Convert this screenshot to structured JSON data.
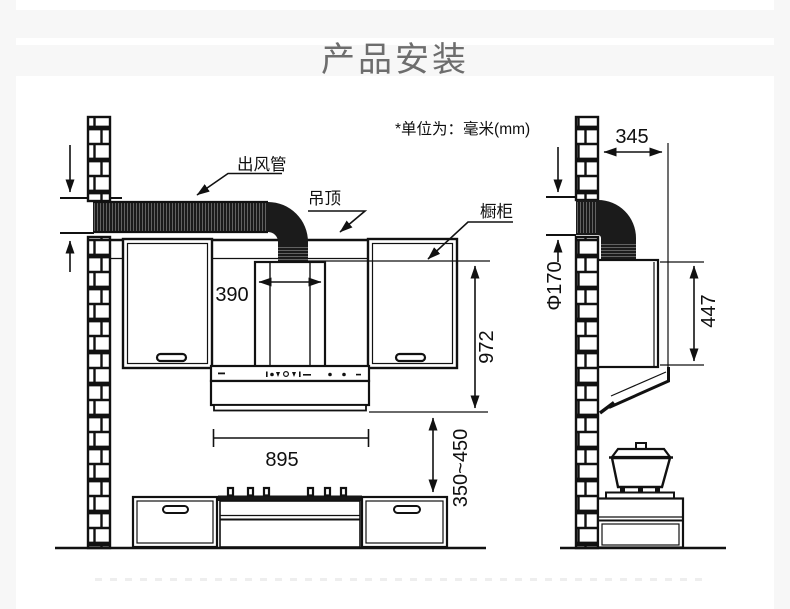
{
  "page": {
    "title": "产品安装",
    "unit_note": "*单位为：毫米(mm)"
  },
  "front_view": {
    "duct_label": "出风管",
    "ceiling_label": "吊顶",
    "cabinet_label": "橱柜",
    "dim_chimney_width": "390",
    "dim_hood_width": "895",
    "dim_ceiling_to_hood_bottom": "972",
    "dim_hood_to_cooktop": "350~450"
  },
  "side_view": {
    "dim_wall_to_front": "345",
    "dim_duct_diameter": "Φ170",
    "dim_chimney_height": "447"
  },
  "colors": {
    "line": "#111111",
    "duct_fill": "#1b1b1b",
    "title_gray": "#6d6d6d",
    "page_bg": "#f7f7f7"
  }
}
